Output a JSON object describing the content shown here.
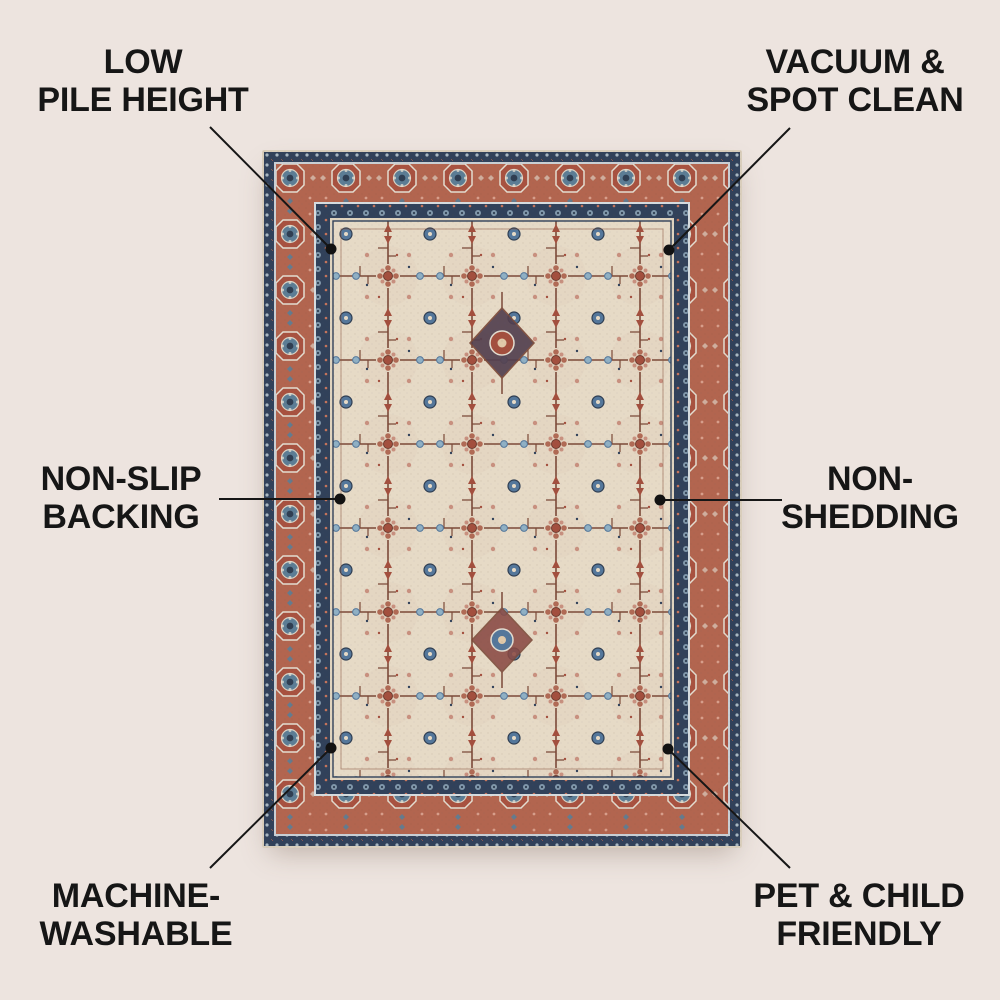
{
  "background_color": "#EDE4DF",
  "text_color": "#161616",
  "line_color": "#161616",
  "callouts": [
    {
      "name": "low-pile-height",
      "line1": "LOW",
      "line2": "PILE HEIGHT"
    },
    {
      "name": "vacuum-spot-clean",
      "line1": "VACUUM &",
      "line2": "SPOT CLEAN"
    },
    {
      "name": "non-slip-backing",
      "line1": "NON-SLIP",
      "line2": "BACKING"
    },
    {
      "name": "non-shedding",
      "line1": "NON-",
      "line2": "SHEDDING"
    },
    {
      "name": "machine-washable",
      "line1": "MACHINE-",
      "line2": "WASHABLE"
    },
    {
      "name": "pet-child-friendly",
      "line1": "PET & CHILD",
      "line2": "FRIENDLY"
    }
  ],
  "rug": {
    "description": "Persian-style area rug, cream field with dense floral branch pattern, terracotta medallion border, navy guard bands",
    "colors": {
      "field": "#E6DAC6",
      "border_red": "#B2654F",
      "border_navy": "#31415A",
      "accent_blue": "#5C7D95",
      "accent_light_blue": "#8FB0C4",
      "accent_rust": "#A34F3E",
      "accent_brown": "#7B4938",
      "accent_pink": "#C8907F",
      "outline_cream": "#E3DDD0"
    }
  }
}
